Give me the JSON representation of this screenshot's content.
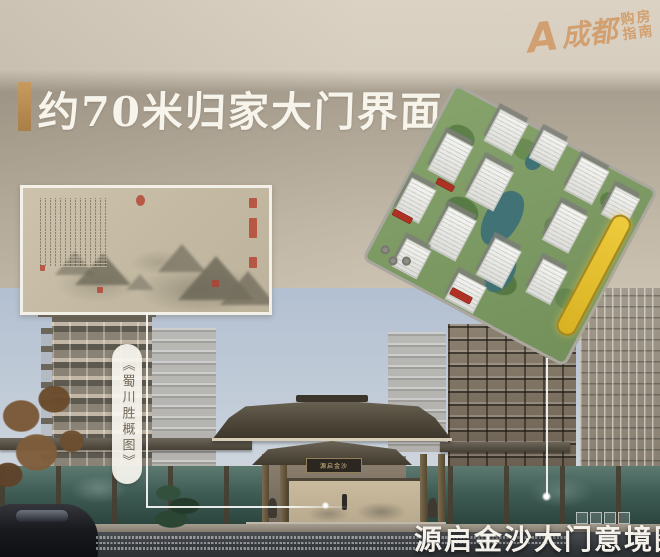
{
  "logo": {
    "prefix": "A",
    "brand": "成都",
    "line1": "购房",
    "line2": "指南"
  },
  "header": {
    "title": "约70米归家大门界面"
  },
  "painting": {
    "label": "《蜀川胜概图》"
  },
  "gate": {
    "plaque": "源启金沙"
  },
  "caption": {
    "text": "源启金沙大门意境图"
  },
  "colors": {
    "accent_gold": "#c09256",
    "title_text": "#f7f4ec",
    "logo_orange": "#d29d6a",
    "aerial_highlight": "#e7c42c",
    "pond_teal": "#3d7077",
    "seal_red": "#b4402e"
  }
}
